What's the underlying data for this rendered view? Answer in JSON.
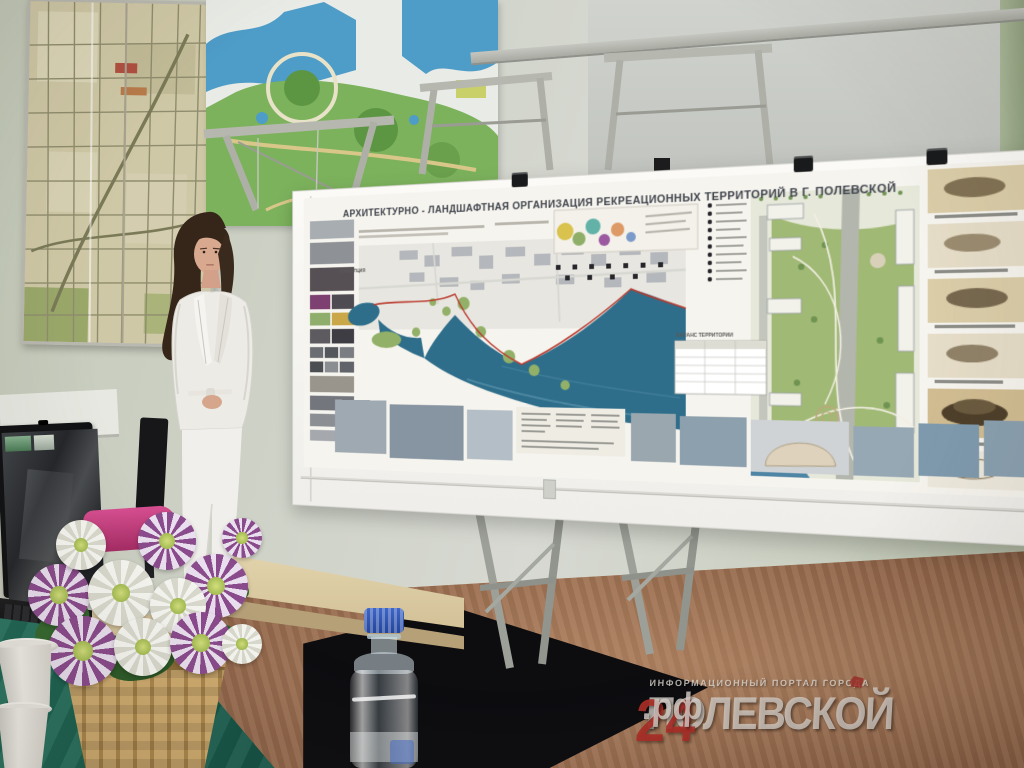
{
  "poster": {
    "title": "АРХИТЕКТУРНО - ЛАНДШАФТНАЯ ОРГАНИЗАЦИЯ РЕКРЕАЦИОННЫХ ТЕРРИТОРИЙ В Г. ПОЛЕВСКОЙ",
    "concept_label": "КОНЦЕПЦИЯ",
    "balance_label": "БАЛАНС ТЕРРИТОРИИ"
  },
  "laptop": {
    "brand": "ASUS"
  },
  "watermark": {
    "tagline": "ИНФОРМАЦИОННЫЙ ПОРТАЛ ГОРОДА",
    "site_name": "ПОЛЕВСКОЙ",
    "site_number": "24",
    "site_suffix": ".рф"
  },
  "colors": {
    "wall": "#cdd1c5",
    "wall_right_strip": "#9fae8e",
    "floor": "#976b4d",
    "tablecloth_green": "#1f6f5a",
    "poster_water": "#2e6e8b",
    "poster_boundary_red": "#b93a2e",
    "watermark_red": "#aa2e27",
    "bottle_cap_blue": "#2b50a8"
  }
}
